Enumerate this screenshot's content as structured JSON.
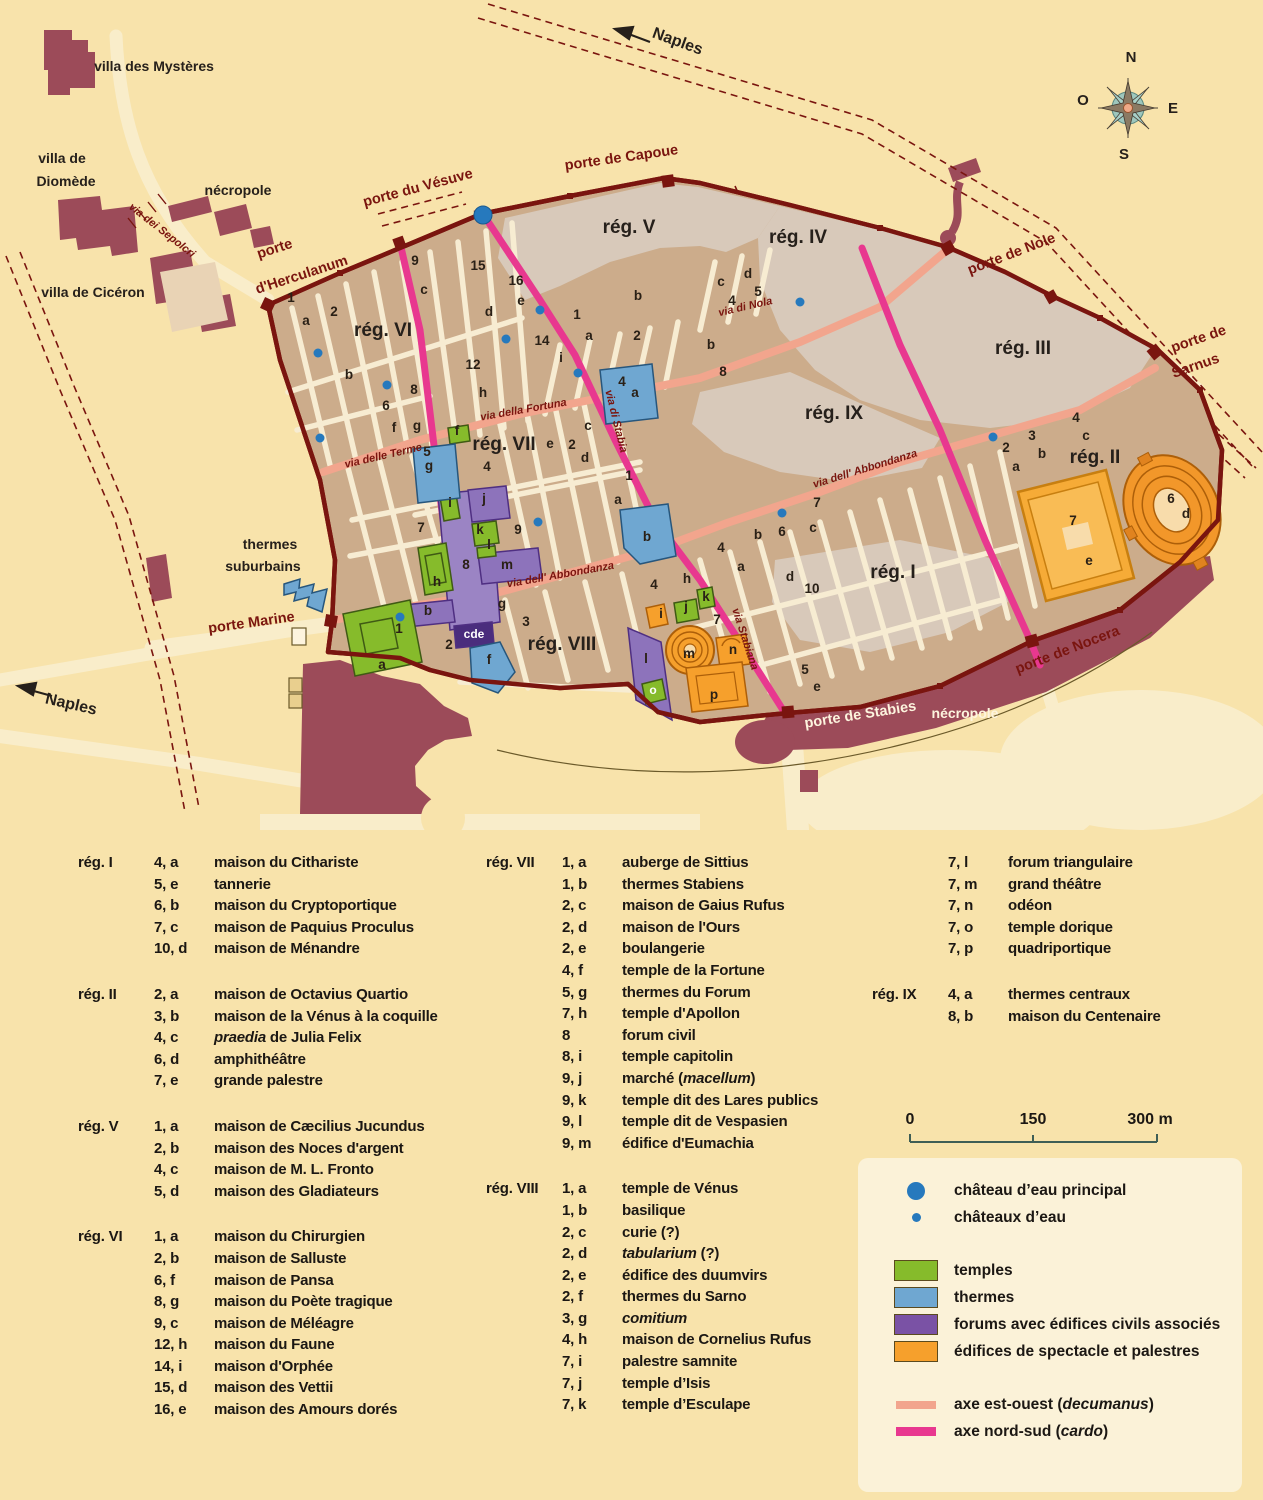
{
  "map": {
    "labels": [
      {
        "t": "porte",
        "x": 276,
        "y": 253,
        "r": -18,
        "c": "gate"
      },
      {
        "t": "d'Herculanum",
        "x": 303,
        "y": 279,
        "r": -18,
        "c": "gate"
      },
      {
        "t": "porte du Vésuve",
        "x": 419,
        "y": 192,
        "r": -15,
        "c": "gate"
      },
      {
        "t": "porte de Capoue",
        "x": 622,
        "y": 162,
        "r": -8,
        "c": "gate"
      },
      {
        "t": "porte de Nole",
        "x": 1013,
        "y": 258,
        "r": -21,
        "c": "gate"
      },
      {
        "t": "porte de",
        "x": 1200,
        "y": 343,
        "r": -19,
        "c": "gate"
      },
      {
        "t": "Sarnus",
        "x": 1197,
        "y": 370,
        "r": -19,
        "c": "gate"
      },
      {
        "t": "porte de Nocera",
        "x": 1069,
        "y": 654,
        "r": -21,
        "c": "gate"
      },
      {
        "t": "porte de Stabies",
        "x": 861,
        "y": 719,
        "r": -9,
        "c": "gatew"
      },
      {
        "t": "porte Marine",
        "x": 252,
        "y": 627,
        "r": -8,
        "c": "gate"
      },
      {
        "t": "rég. VI",
        "x": 383,
        "y": 336,
        "r": 0,
        "c": "region"
      },
      {
        "t": "rég. V",
        "x": 629,
        "y": 233,
        "r": 0,
        "c": "region"
      },
      {
        "t": "rég. IV",
        "x": 798,
        "y": 243,
        "r": 0,
        "c": "region"
      },
      {
        "t": "rég. III",
        "x": 1023,
        "y": 354,
        "r": 0,
        "c": "region"
      },
      {
        "t": "rég. IX",
        "x": 834,
        "y": 419,
        "r": 0,
        "c": "region"
      },
      {
        "t": "rég. II",
        "x": 1095,
        "y": 463,
        "r": 0,
        "c": "region"
      },
      {
        "t": "rég. VII",
        "x": 504,
        "y": 450,
        "r": 0,
        "c": "region"
      },
      {
        "t": "rég. I",
        "x": 893,
        "y": 578,
        "r": 0,
        "c": "region"
      },
      {
        "t": "rég. VIII",
        "x": 562,
        "y": 650,
        "r": 0,
        "c": "region"
      },
      {
        "t": "via dei Sepolcri",
        "x": 160,
        "y": 233,
        "r": 38,
        "c": "street"
      },
      {
        "t": "via delle Terme",
        "x": 384,
        "y": 459,
        "r": -13,
        "c": "street"
      },
      {
        "t": "via della Fortuna",
        "x": 524,
        "y": 413,
        "r": -10,
        "c": "street"
      },
      {
        "t": "via di Nola",
        "x": 746,
        "y": 310,
        "r": -13,
        "c": "street"
      },
      {
        "t": "via di Stabia",
        "x": 613,
        "y": 422,
        "r": 76,
        "c": "street"
      },
      {
        "t": "via Stabiana",
        "x": 742,
        "y": 640,
        "r": 72,
        "c": "street"
      },
      {
        "t": "via dell' Abbondanza",
        "x": 561,
        "y": 578,
        "r": -10,
        "c": "street"
      },
      {
        "t": "via dell' Abbondanza",
        "x": 866,
        "y": 472,
        "r": -17,
        "c": "street"
      },
      {
        "t": "villa des Mystères",
        "x": 154,
        "y": 71,
        "r": 0,
        "c": "place"
      },
      {
        "t": "villa de",
        "x": 62,
        "y": 163,
        "r": 0,
        "c": "place"
      },
      {
        "t": "Diomède",
        "x": 66,
        "y": 186,
        "r": 0,
        "c": "place"
      },
      {
        "t": "nécropole",
        "x": 238,
        "y": 195,
        "r": 0,
        "c": "place"
      },
      {
        "t": "villa de Cicéron",
        "x": 93,
        "y": 297,
        "r": 0,
        "c": "place"
      },
      {
        "t": "thermes",
        "x": 270,
        "y": 549,
        "r": 0,
        "c": "place"
      },
      {
        "t": "suburbains",
        "x": 263,
        "y": 571,
        "r": 0,
        "c": "place"
      },
      {
        "t": "nécropole",
        "x": 965,
        "y": 718,
        "r": 0,
        "c": "placew"
      },
      {
        "t": "Naples",
        "x": 676,
        "y": 46,
        "r": 20,
        "c": "naples"
      },
      {
        "t": "Naples",
        "x": 70,
        "y": 709,
        "r": 13,
        "c": "naples"
      },
      {
        "t": "N",
        "x": 1131,
        "y": 62,
        "r": 0,
        "c": "compass"
      },
      {
        "t": "E",
        "x": 1173,
        "y": 113,
        "r": 0,
        "c": "compass"
      },
      {
        "t": "S",
        "x": 1124,
        "y": 159,
        "r": 0,
        "c": "compass"
      },
      {
        "t": "O",
        "x": 1083,
        "y": 105,
        "r": 0,
        "c": "compass"
      }
    ],
    "blocks": [
      [
        "1",
        291,
        302
      ],
      [
        "a",
        306,
        325
      ],
      [
        "2",
        334,
        316
      ],
      [
        "b",
        349,
        379
      ],
      [
        "9",
        415,
        265
      ],
      [
        "c",
        424,
        294
      ],
      [
        "15",
        478,
        270
      ],
      [
        "d",
        489,
        316
      ],
      [
        "16",
        516,
        285
      ],
      [
        "e",
        521,
        305
      ],
      [
        "14",
        542,
        345
      ],
      [
        "i",
        561,
        362
      ],
      [
        "12",
        473,
        369
      ],
      [
        "h",
        483,
        397
      ],
      [
        "8",
        414,
        394
      ],
      [
        "6",
        386,
        410
      ],
      [
        "f",
        394,
        432
      ],
      [
        "g",
        417,
        430
      ],
      [
        "5",
        427,
        456
      ],
      [
        "g",
        429,
        470
      ],
      [
        "f",
        457,
        435
      ],
      [
        "e",
        550,
        448
      ],
      [
        "2",
        572,
        449
      ],
      [
        "c",
        588,
        430
      ],
      [
        "d",
        585,
        462
      ],
      [
        "4",
        487,
        471
      ],
      [
        "7",
        421,
        532
      ],
      [
        "9",
        518,
        534
      ],
      [
        "i",
        450,
        507
      ],
      [
        "j",
        484,
        503
      ],
      [
        "k",
        480,
        534
      ],
      [
        "l",
        489,
        549
      ],
      [
        "8",
        466,
        569
      ],
      [
        "h",
        437,
        586
      ],
      [
        "m",
        507,
        569
      ],
      [
        "g",
        502,
        608
      ],
      [
        "b",
        428,
        615
      ],
      [
        "3",
        526,
        626
      ],
      [
        "2",
        449,
        649
      ],
      [
        "1",
        629,
        480
      ],
      [
        "a",
        618,
        504
      ],
      [
        "b",
        647,
        541
      ],
      [
        "1",
        399,
        633
      ],
      [
        "a",
        382,
        669
      ],
      [
        "f",
        489,
        664
      ],
      [
        "cde",
        474,
        638,
        "w"
      ],
      [
        "4",
        654,
        589
      ],
      [
        "h",
        687,
        583
      ],
      [
        "i",
        661,
        618
      ],
      [
        "j",
        686,
        611
      ],
      [
        "k",
        706,
        601
      ],
      [
        "7",
        717,
        624
      ],
      [
        "l",
        646,
        663
      ],
      [
        "o",
        653,
        694,
        "w"
      ],
      [
        "m",
        689,
        658
      ],
      [
        "n",
        733,
        654
      ],
      [
        "p",
        714,
        699
      ],
      [
        "4",
        721,
        552
      ],
      [
        "a",
        741,
        571
      ],
      [
        "b",
        758,
        539
      ],
      [
        "6",
        782,
        536
      ],
      [
        "7",
        817,
        507
      ],
      [
        "c",
        813,
        532
      ],
      [
        "d",
        790,
        581
      ],
      [
        "10",
        812,
        593
      ],
      [
        "5",
        805,
        674
      ],
      [
        "e",
        817,
        691
      ],
      [
        "4",
        622,
        386
      ],
      [
        "a",
        635,
        397
      ],
      [
        "b",
        711,
        349
      ],
      [
        "8",
        723,
        376
      ],
      [
        "1",
        577,
        319
      ],
      [
        "a",
        589,
        340
      ],
      [
        "2",
        637,
        340
      ],
      [
        "b",
        638,
        300
      ],
      [
        "c",
        721,
        286
      ],
      [
        "4",
        732,
        305
      ],
      [
        "d",
        748,
        278
      ],
      [
        "5",
        758,
        296
      ],
      [
        "2",
        1006,
        452
      ],
      [
        "a",
        1016,
        471
      ],
      [
        "3",
        1032,
        440
      ],
      [
        "b",
        1042,
        458
      ],
      [
        "4",
        1076,
        422
      ],
      [
        "c",
        1086,
        440
      ],
      [
        "7",
        1073,
        525
      ],
      [
        "e",
        1089,
        565
      ],
      [
        "6",
        1171,
        503
      ],
      [
        "d",
        1186,
        518
      ]
    ],
    "dots": {
      "main": [
        [
          483,
          215
        ]
      ],
      "small": [
        [
          318,
          353
        ],
        [
          387,
          385
        ],
        [
          320,
          438
        ],
        [
          540,
          310
        ],
        [
          506,
          339
        ],
        [
          578,
          373
        ],
        [
          800,
          302
        ],
        [
          993,
          437
        ],
        [
          782,
          513
        ],
        [
          538,
          522
        ],
        [
          400,
          617
        ]
      ]
    },
    "colors": {
      "background": "#f8e3ab",
      "excavated": "#ccac8b",
      "unexcavated": "#d8c9ba",
      "street": "#f7ecd2",
      "wall": "#7a150f",
      "maroon": "#9c4b59",
      "decumanus": "#f2a58d",
      "cardo": "#e8388f",
      "temples": "#86bb2b",
      "thermes": "#6fa7d1",
      "forums": "#8d73bb",
      "spectacles": "#f6a02c",
      "water_dot": "#2679bd"
    }
  },
  "scalebar": {
    "start": "0",
    "mid": "150",
    "end": "300 m"
  },
  "index": {
    "col1": [
      {
        "reg": "rég. I",
        "num": "4, a",
        "name": "maison du Cithariste"
      },
      {
        "num": "5, e",
        "name": "tannerie"
      },
      {
        "num": "6, b",
        "name": "maison du Cryptoportique"
      },
      {
        "num": "7, c",
        "name": "maison de Paquius Proculus"
      },
      {
        "num": "10, d",
        "name": "maison de Ménandre"
      },
      {
        "reg": "rég. II",
        "gap": true,
        "num": "2, a",
        "name": "maison de Octavius Quartio"
      },
      {
        "num": "3, b",
        "name": "maison de la Vénus à la coquille"
      },
      {
        "num": "4, c",
        "name": "*praedia* de Julia Felix"
      },
      {
        "num": "6, d",
        "name": "amphithéâtre"
      },
      {
        "num": "7, e",
        "name": "grande palestre"
      },
      {
        "reg": "rég. V",
        "gap": true,
        "num": "1, a",
        "name": "maison de Cæcilius Jucundus"
      },
      {
        "num": "2, b",
        "name": "maison des Noces d'argent"
      },
      {
        "num": "4, c",
        "name": "maison de M. L. Fronto"
      },
      {
        "num": "5, d",
        "name": "maison des Gladiateurs"
      },
      {
        "reg": "rég. VI",
        "gap": true,
        "num": "1, a",
        "name": "maison du Chirurgien"
      },
      {
        "num": "2, b",
        "name": "maison de Salluste"
      },
      {
        "num": "6, f",
        "name": "maison de Pansa"
      },
      {
        "num": "8, g",
        "name": "maison du Poète tragique"
      },
      {
        "num": "9, c",
        "name": "maison de Méléagre"
      },
      {
        "num": "12, h",
        "name": "maison du Faune"
      },
      {
        "num": "14, i",
        "name": "maison d'Orphée"
      },
      {
        "num": "15, d",
        "name": "maison des Vettii"
      },
      {
        "num": "16, e",
        "name": "maison des Amours dorés"
      }
    ],
    "col2": [
      {
        "reg": "rég. VII",
        "num": "1, a",
        "name": "auberge de Sittius"
      },
      {
        "num": "1, b",
        "name": "thermes Stabiens"
      },
      {
        "num": "2, c",
        "name": "maison de Gaius Rufus"
      },
      {
        "num": "2, d",
        "name": "maison de l'Ours"
      },
      {
        "num": "2, e",
        "name": "boulangerie"
      },
      {
        "num": "4, f",
        "name": "temple de la Fortune"
      },
      {
        "num": "5, g",
        "name": "thermes du Forum"
      },
      {
        "num": "7, h",
        "name": "temple d'Apollon"
      },
      {
        "num": "8",
        "name": "forum civil"
      },
      {
        "num": "8, i",
        "name": "temple capitolin"
      },
      {
        "num": "9, j",
        "name": "marché (*macellum*)"
      },
      {
        "num": "9, k",
        "name": "temple dit des Lares publics"
      },
      {
        "num": "9, l",
        "name": "temple dit de Vespasien"
      },
      {
        "num": "9, m",
        "name": "édifice d'Eumachia"
      },
      {
        "reg": "rég. VIII",
        "gap": true,
        "num": "1, a",
        "name": "temple de Vénus"
      },
      {
        "num": "1, b",
        "name": "basilique"
      },
      {
        "num": "2, c",
        "name": "curie (?)"
      },
      {
        "num": "2, d",
        "name": "*tabularium* (?)"
      },
      {
        "num": "2, e",
        "name": "édifice des duumvirs"
      },
      {
        "num": "2, f",
        "name": "thermes du Sarno"
      },
      {
        "num": "3, g",
        "name": "*comitium*"
      },
      {
        "num": "4, h",
        "name": "maison de Cornelius Rufus"
      },
      {
        "num": "7, i",
        "name": "palestre samnite"
      },
      {
        "num": "7, j",
        "name": "temple d’Isis"
      },
      {
        "num": "7, k",
        "name": "temple d’Esculape"
      }
    ],
    "col3": [
      {
        "num": "7, l",
        "name": "forum triangulaire"
      },
      {
        "num": "7, m",
        "name": "grand théâtre"
      },
      {
        "num": "7, n",
        "name": "odéon"
      },
      {
        "num": "7, o",
        "name": "temple dorique"
      },
      {
        "num": "7, p",
        "name": "quadriportique"
      },
      {
        "reg": "rég. IX",
        "gap": true,
        "num": "4, a",
        "name": "thermes centraux"
      },
      {
        "num": "8, b",
        "name": "maison du Centenaire"
      }
    ]
  },
  "legend": {
    "items": [
      {
        "type": "dotbig",
        "color": "#2679bd",
        "label": "château d’eau principal"
      },
      {
        "type": "dotsmall",
        "color": "#2679bd",
        "label": "châteaux d’eau"
      },
      {
        "type": "box",
        "color": "#86bb2b",
        "label": "temples",
        "gap": true
      },
      {
        "type": "box",
        "color": "#6fa7d1",
        "label": "thermes"
      },
      {
        "type": "box",
        "color": "#7a52a5",
        "label": "forums avec édifices civils associés"
      },
      {
        "type": "box",
        "color": "#f6a02c",
        "label": "édifices de spectacle et palestres"
      },
      {
        "type": "lineA",
        "color": "#f2a58d",
        "label": "axe est-ouest (*decumanus*)",
        "gap": true
      },
      {
        "type": "lineB",
        "color": "#e8388f",
        "label": "axe nord-sud (*cardo*)"
      }
    ]
  }
}
